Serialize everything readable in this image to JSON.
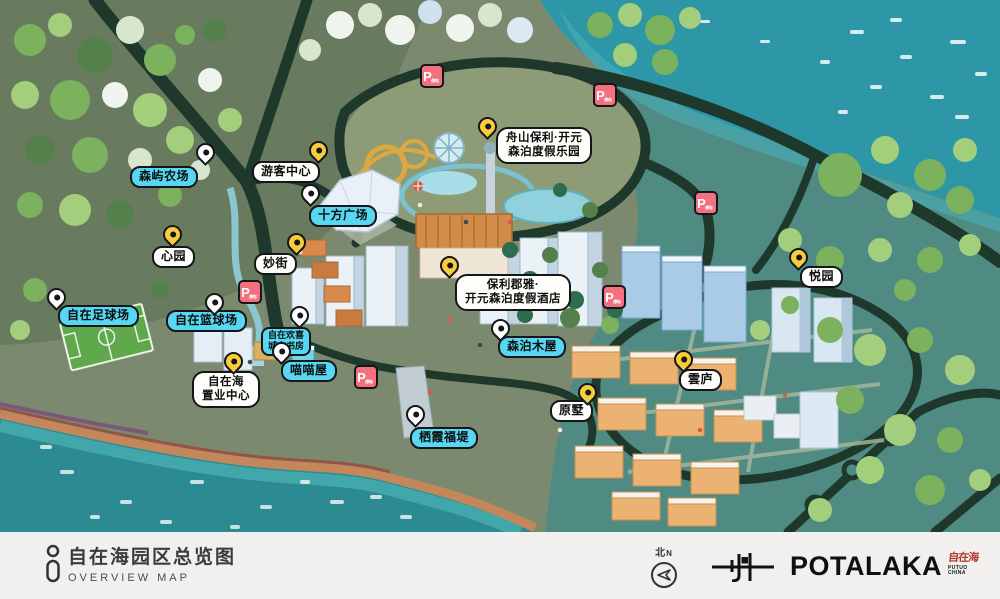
{
  "map": {
    "parking": {
      "letter": "P",
      "sub": "停车"
    },
    "labels": {
      "senyu_farm": {
        "text": "森屿农场"
      },
      "visitor_center": {
        "text": "游客中心"
      },
      "shifang_square": {
        "text": "十方广场"
      },
      "xinyuan": {
        "text": "心园"
      },
      "miaojie": {
        "text": "妙街"
      },
      "football_field": {
        "text": "自在足球场"
      },
      "basketball_court": {
        "text": "自在篮球场"
      },
      "city_study": {
        "line1": "自在欢喜",
        "line2": "城市书房"
      },
      "miaomiao_house": {
        "text": "喵喵屋"
      },
      "sales_center": {
        "line1": "自在海",
        "line2": "置业中心"
      },
      "resort_park": {
        "line1": "舟山保利·开元",
        "line2": "森泊度假乐园"
      },
      "resort_hotel": {
        "line1": "保利郡雅·",
        "line2": "开元森泊度假酒店"
      },
      "senpo_cabin": {
        "text": "森泊木屋"
      },
      "yueyuan": {
        "text": "悦园"
      },
      "yunlu": {
        "text": "雲庐"
      },
      "yuanshu": {
        "text": "原墅"
      },
      "qixia_causeway": {
        "text": "栖霞福堤"
      }
    }
  },
  "footer": {
    "title_cn": "自在海园区总览图",
    "title_en": "OVERVIEW MAP",
    "compass_north_cn": "北",
    "compass_north_en": "N",
    "brand_name": "POTALAKA",
    "brand_seal_cn": "自在海",
    "brand_sub_line1": "PUTUO",
    "brand_sub_line2": "CHINA"
  },
  "colors": {
    "label_cyan": "#57D7F2",
    "pin_yellow": "#F6CE3C",
    "parking_red": "#F3717E",
    "sea_teal": "#2E97A7",
    "land_olive": "#7B8A6F",
    "road_dark": "#1F382C"
  }
}
